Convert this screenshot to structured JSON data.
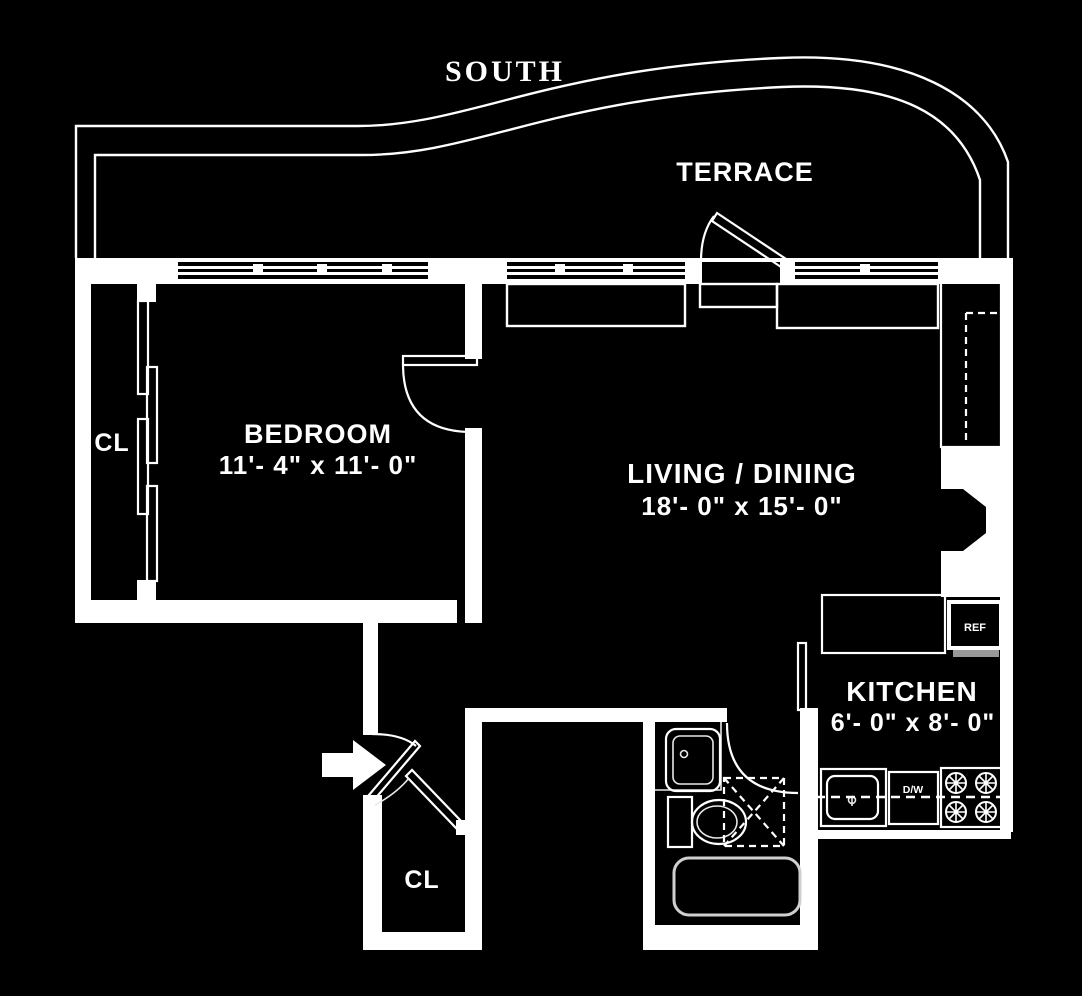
{
  "orientation": {
    "label": "SOUTH"
  },
  "terrace": {
    "label": "TERRACE"
  },
  "bedroom": {
    "label": "BEDROOM",
    "dims": "11'- 4\" x 11'- 0\""
  },
  "living": {
    "label": "LIVING / DINING",
    "dims": "18'- 0\" x 15'- 0\""
  },
  "kitchen": {
    "label": "KITCHEN",
    "dims": "6'- 0\" x 8'- 0\""
  },
  "closet_left": {
    "label": "CL"
  },
  "closet_entry": {
    "label": "CL"
  },
  "appliances": {
    "refrigerator": "REF",
    "dishwasher": "D/W"
  },
  "colors": {
    "background": "#000000",
    "wall": "#ffffff"
  }
}
